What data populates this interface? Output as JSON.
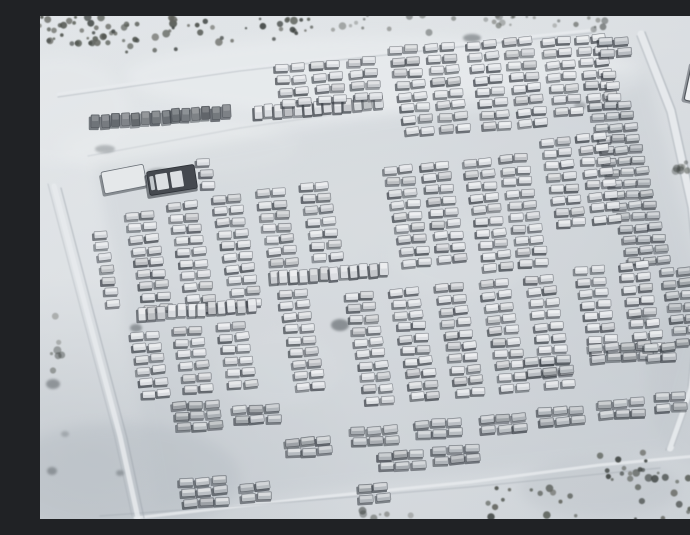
{
  "meta": {
    "title": "Satellite photograph of a snow-covered military vehicle staging area with hundreds of vehicles parked in rows, tree lines at the edges, access roads and tracks"
  },
  "scene": {
    "width": 690,
    "height": 503,
    "seed": 7,
    "palette": {
      "snow_base": "#d6dade",
      "snow_bright": "#eceff1",
      "snow_shade": "#b9bfc6",
      "track_bright": "#e8ebee",
      "track_dark": "#99a0a8",
      "vehicle_shadow": "#3a3f46",
      "tone_light": "#d7dade",
      "tone_mid": "#b3b8bd",
      "tone_dark": "#6e7378",
      "tree_palette": [
        "#4b4f4a",
        "#5a5e58",
        "#3e423f",
        "#63655e"
      ],
      "park_overlay": "#b6bdc4"
    },
    "snow_patches": [
      {
        "x": 345,
        "y": 60,
        "rx": 260,
        "ry": 40,
        "color": "#eceff1",
        "op": 0.5
      },
      {
        "x": 140,
        "y": 132,
        "rx": 120,
        "ry": 30,
        "color": "#e9eced",
        "op": 0.5
      },
      {
        "x": 20,
        "y": 95,
        "rx": 70,
        "ry": 55,
        "color": "#e8ebed",
        "op": 0.45
      },
      {
        "x": 420,
        "y": 240,
        "rx": 70,
        "ry": 40,
        "color": "#e7eaec",
        "op": 0.3
      },
      {
        "x": 240,
        "y": 352,
        "rx": 60,
        "ry": 40,
        "color": "#e4e8ea",
        "op": 0.28
      },
      {
        "x": 80,
        "y": 462,
        "rx": 120,
        "ry": 55,
        "color": "#aeb6bd",
        "op": 0.3
      },
      {
        "x": 662,
        "y": 360,
        "rx": 55,
        "ry": 90,
        "color": "#c2c8cd",
        "op": 0.35
      },
      {
        "x": 560,
        "y": 472,
        "rx": 80,
        "ry": 30,
        "color": "#b6bcc2",
        "op": 0.3
      }
    ],
    "park_overlay_polygon": "56,150 606,52 668,300 630,436 118,492",
    "tracks": [
      {
        "pts": [
          [
            18,
            78
          ],
          [
            200,
            52
          ],
          [
            400,
            30
          ],
          [
            552,
            14
          ]
        ],
        "w": 2.6,
        "color": "bright",
        "op": 0.85
      },
      {
        "pts": [
          [
            18,
            81
          ],
          [
            200,
            55
          ],
          [
            400,
            33
          ],
          [
            552,
            17
          ]
        ],
        "w": 1.0,
        "color": "dark",
        "op": 0.45
      },
      {
        "pts": [
          [
            601,
            18
          ],
          [
            631,
            95
          ],
          [
            652,
            190
          ],
          [
            661,
            280
          ],
          [
            652,
            370
          ],
          [
            630,
            432
          ]
        ],
        "w": 7,
        "color": "bright",
        "op": 0.9
      },
      {
        "pts": [
          [
            605,
            16
          ],
          [
            635,
            93
          ],
          [
            656,
            188
          ],
          [
            665,
            278
          ],
          [
            656,
            368
          ],
          [
            634,
            430
          ]
        ],
        "w": 1.3,
        "color": "dark",
        "op": 0.5
      },
      {
        "pts": [
          [
            597,
            20
          ],
          [
            627,
            97
          ],
          [
            648,
            192
          ],
          [
            657,
            282
          ],
          [
            648,
            372
          ],
          [
            626,
            434
          ]
        ],
        "w": 1.3,
        "color": "dark",
        "op": 0.4
      },
      {
        "pts": [
          [
            95,
            502
          ],
          [
            280,
            481
          ],
          [
            430,
            466
          ],
          [
            560,
            449
          ],
          [
            688,
            437
          ]
        ],
        "w": 3,
        "color": "bright",
        "op": 0.8
      },
      {
        "pts": [
          [
            60,
            500
          ],
          [
            250,
            486
          ],
          [
            430,
            471
          ],
          [
            620,
            452
          ]
        ],
        "w": 1.4,
        "color": "dark",
        "op": 0.35
      },
      {
        "pts": [
          [
            14,
            170
          ],
          [
            48,
            300
          ],
          [
            80,
            420
          ],
          [
            98,
            502
          ]
        ],
        "w": 5,
        "color": "bright",
        "op": 0.85
      },
      {
        "pts": [
          [
            21,
            172
          ],
          [
            55,
            302
          ],
          [
            87,
            422
          ],
          [
            104,
            502
          ]
        ],
        "w": 1.3,
        "color": "dark",
        "op": 0.5
      },
      {
        "pts": [
          [
            8,
            168
          ],
          [
            42,
            298
          ],
          [
            74,
            418
          ],
          [
            92,
            500
          ]
        ],
        "w": 1.1,
        "color": "dark",
        "op": 0.35
      },
      {
        "pts": [
          [
            48,
            140
          ],
          [
            200,
            112
          ],
          [
            340,
            92
          ]
        ],
        "w": 1.4,
        "color": "dark",
        "op": 0.22
      }
    ],
    "dark_patches": [
      {
        "x": 300,
        "y": 309,
        "rx": 9,
        "ry": 6,
        "op": 0.5
      },
      {
        "x": 96,
        "y": 312,
        "rx": 6,
        "ry": 4,
        "op": 0.45
      },
      {
        "x": 600,
        "y": 304,
        "rx": 10,
        "ry": 5,
        "op": 0.4
      },
      {
        "x": 13,
        "y": 368,
        "rx": 7,
        "ry": 5,
        "op": 0.45
      },
      {
        "x": 12,
        "y": 455,
        "rx": 5,
        "ry": 4,
        "op": 0.4
      },
      {
        "x": 80,
        "y": 457,
        "rx": 4,
        "ry": 3,
        "op": 0.35
      },
      {
        "x": 25,
        "y": 418,
        "rx": 4,
        "ry": 3,
        "op": 0.25
      },
      {
        "x": 120,
        "y": 158,
        "rx": 14,
        "ry": 6,
        "op": 0.3
      },
      {
        "x": 432,
        "y": 22,
        "rx": 9,
        "ry": 4,
        "op": 0.45
      },
      {
        "x": 65,
        "y": 133,
        "rx": 10,
        "ry": 4,
        "op": 0.3
      },
      {
        "x": 540,
        "y": 90,
        "rx": 6,
        "ry": 4,
        "op": 0.3
      }
    ],
    "trees": {
      "clusters": [
        {
          "cx": 28,
          "cy": 14,
          "rx": 34,
          "ry": 14,
          "count": 26
        },
        {
          "cx": 96,
          "cy": 24,
          "rx": 40,
          "ry": 16,
          "count": 22
        },
        {
          "cx": 180,
          "cy": 14,
          "rx": 55,
          "ry": 13,
          "count": 18
        },
        {
          "cx": 252,
          "cy": 9,
          "rx": 28,
          "ry": 9,
          "count": 12
        },
        {
          "cx": 330,
          "cy": 7,
          "rx": 40,
          "ry": 8,
          "count": 9,
          "faint": true
        },
        {
          "cx": 455,
          "cy": 8,
          "rx": 75,
          "ry": 9,
          "count": 16,
          "faint": true
        },
        {
          "cx": 555,
          "cy": 7,
          "rx": 25,
          "ry": 7,
          "count": 7,
          "faint": true
        },
        {
          "cx": 640,
          "cy": 478,
          "rx": 52,
          "ry": 26,
          "count": 30
        },
        {
          "cx": 582,
          "cy": 452,
          "rx": 28,
          "ry": 16,
          "count": 12
        },
        {
          "cx": 492,
          "cy": 487,
          "rx": 45,
          "ry": 15,
          "count": 14
        },
        {
          "cx": 12,
          "cy": 345,
          "rx": 10,
          "ry": 45,
          "count": 7,
          "faint": true
        },
        {
          "cx": 358,
          "cy": 499,
          "rx": 38,
          "ry": 6,
          "count": 6,
          "faint": true
        },
        {
          "cx": 668,
          "cy": 228,
          "rx": 8,
          "ry": 55,
          "count": 10,
          "faint": true
        },
        {
          "cx": 643,
          "cy": 153,
          "rx": 13,
          "ry": 9,
          "count": 7,
          "faint": true
        }
      ]
    },
    "structures": {
      "building": {
        "x": 656,
        "y": 66,
        "w": 16,
        "h": 40,
        "rot": 12,
        "fill": "#eef0f2",
        "stroke": "#53585e"
      },
      "shelter": {
        "x": 84,
        "y": 163,
        "w": 43,
        "h": 22,
        "rot": -11,
        "fill": "#e5e8ea",
        "stroke": "#6a7077"
      },
      "transporter": {
        "x": 132,
        "y": 164,
        "w": 48,
        "h": 24,
        "rot": -9,
        "fill": "#45494f",
        "panel": "#dde0e3"
      }
    },
    "formation_defaults": {
      "pair": {
        "rows": 8,
        "cols": 2,
        "vw": 13,
        "vh": 7,
        "rs": [
          2.3,
          11.6
        ],
        "cs": [
          15.5,
          -1.4
        ],
        "vr": -4,
        "tone": "light"
      },
      "col": {
        "rows": 5,
        "cols": 1,
        "vw": 13,
        "vh": 7,
        "rs": [
          2.3,
          11.6
        ],
        "cs": [
          15.5,
          -1.4
        ],
        "vr": -4,
        "tone": "light"
      },
      "row": {
        "rows": 1,
        "cols": 12,
        "vw": 8.5,
        "vh": 13,
        "rs": [
          2.3,
          11.6
        ],
        "cs": [
          10,
          -0.8
        ],
        "vr": -3,
        "tone": "light"
      },
      "dense": {
        "rows": 15,
        "cols": 3,
        "vw": 13,
        "vh": 6.6,
        "rs": [
          2.8,
          11.1
        ],
        "cs": [
          14.5,
          -1.0
        ],
        "vr": -4,
        "tone": "mid"
      },
      "cluster": {
        "rows": 2,
        "cols": 3,
        "vw": 14,
        "vh": 7.5,
        "rs": [
          2.0,
          10.5
        ],
        "cs": [
          16,
          -1.2
        ],
        "vr": -4,
        "tone": "mid"
      }
    },
    "formations": [
      {
        "id": "row-nw-dark",
        "type": "row",
        "x": 56,
        "y": 106,
        "cols": 14,
        "tone": "dark"
      },
      {
        "id": "row-n-light",
        "type": "row",
        "x": 218,
        "y": 96,
        "cols": 13
      },
      {
        "id": "p-top-1",
        "type": "pair",
        "x": 242,
        "y": 52,
        "rows": 4
      },
      {
        "id": "p-top-2",
        "type": "pair",
        "x": 278,
        "y": 49,
        "rows": 4
      },
      {
        "id": "p-top-3",
        "type": "pair",
        "x": 314,
        "y": 46,
        "rows": 4
      },
      {
        "id": "p-top-4",
        "type": "pair",
        "x": 356,
        "y": 34,
        "rows": 8
      },
      {
        "id": "p-top-5",
        "type": "pair",
        "x": 392,
        "y": 31,
        "rows": 8
      },
      {
        "id": "p-top-6",
        "type": "pair",
        "x": 434,
        "y": 29,
        "rows": 8
      },
      {
        "id": "p-top-7",
        "type": "pair",
        "x": 470,
        "y": 26,
        "rows": 8
      },
      {
        "id": "p-top-8",
        "type": "pair",
        "x": 508,
        "y": 26,
        "rows": 7
      },
      {
        "id": "p-top-9",
        "type": "pair",
        "x": 543,
        "y": 23,
        "rows": 6
      },
      {
        "id": "c-top-ne",
        "type": "cluster",
        "x": 566,
        "y": 26,
        "rows": 2,
        "cols": 2
      },
      {
        "id": "col-ne-small",
        "type": "col",
        "x": 570,
        "y": 58,
        "rows": 3
      },
      {
        "id": "dense-ne",
        "type": "dense",
        "x": 556,
        "y": 90
      },
      {
        "id": "col-w-single",
        "type": "col",
        "x": 60,
        "y": 218,
        "rows": 7
      },
      {
        "id": "p-mid-w1",
        "type": "pair",
        "x": 92,
        "y": 200,
        "rows": 9
      },
      {
        "id": "p-mid-w2",
        "type": "pair",
        "x": 135,
        "y": 190,
        "rows": 10
      },
      {
        "id": "p-mid-w3",
        "type": "pair",
        "x": 179,
        "y": 183,
        "rows": 10
      },
      {
        "id": "p-mid-w4",
        "type": "pair",
        "x": 223,
        "y": 177,
        "rows": 7
      },
      {
        "id": "p-mid-w5",
        "type": "pair",
        "x": 267,
        "y": 171,
        "rows": 7
      },
      {
        "id": "row-mid-w",
        "type": "row",
        "x": 102,
        "y": 298,
        "cols": 12
      },
      {
        "id": "row-mid-c",
        "type": "row",
        "x": 234,
        "y": 262,
        "cols": 12
      },
      {
        "id": "p-mid-c1",
        "type": "pair",
        "x": 351,
        "y": 154,
        "rows": 9
      },
      {
        "id": "p-mid-c2",
        "type": "pair",
        "x": 387,
        "y": 150,
        "rows": 9
      },
      {
        "id": "p-mid-c3",
        "type": "pair",
        "x": 430,
        "y": 147,
        "rows": 10
      },
      {
        "id": "p-mid-c4",
        "type": "pair",
        "x": 466,
        "y": 143,
        "rows": 10
      },
      {
        "id": "p-mid-e1",
        "type": "pair",
        "x": 508,
        "y": 126,
        "rows": 8
      },
      {
        "id": "p-mid-e2",
        "type": "pair",
        "x": 544,
        "y": 122,
        "rows": 8
      },
      {
        "id": "p-low-w1",
        "type": "pair",
        "x": 97,
        "y": 320,
        "rows": 6
      },
      {
        "id": "p-low-w2",
        "type": "pair",
        "x": 140,
        "y": 315,
        "rows": 6
      },
      {
        "id": "p-low-w3",
        "type": "pair",
        "x": 184,
        "y": 310,
        "rows": 6
      },
      {
        "id": "p-low-w4",
        "type": "pair",
        "x": 245,
        "y": 278,
        "rows": 9
      },
      {
        "id": "p-low-c1",
        "type": "pair",
        "x": 312,
        "y": 280,
        "rows": 10
      },
      {
        "id": "p-low-c2",
        "type": "pair",
        "x": 357,
        "y": 276,
        "rows": 10
      },
      {
        "id": "p-low-c3",
        "type": "pair",
        "x": 402,
        "y": 272,
        "rows": 10
      },
      {
        "id": "p-low-c4",
        "type": "pair",
        "x": 447,
        "y": 268,
        "rows": 10
      },
      {
        "id": "p-low-c5",
        "type": "pair",
        "x": 492,
        "y": 264,
        "rows": 10
      },
      {
        "id": "p-low-e1",
        "type": "pair",
        "x": 542,
        "y": 254,
        "rows": 8
      },
      {
        "id": "p-low-e2",
        "type": "pair",
        "x": 586,
        "y": 250,
        "rows": 8
      },
      {
        "id": "p-low-e3",
        "type": "pair",
        "x": 628,
        "y": 256,
        "rows": 7,
        "tone": "mid"
      },
      {
        "id": "col-nw-trucks",
        "type": "col",
        "x": 164,
        "y": 146,
        "rows": 3
      },
      {
        "id": "cl-sw-1",
        "type": "cluster",
        "x": 140,
        "y": 390,
        "rows": 3
      },
      {
        "id": "cl-sw-2",
        "type": "cluster",
        "x": 200,
        "y": 394,
        "rows": 2
      },
      {
        "id": "cl-s-1",
        "type": "cluster",
        "x": 252,
        "y": 426
      },
      {
        "id": "cl-s-2",
        "type": "cluster",
        "x": 318,
        "y": 415
      },
      {
        "id": "cl-s-3",
        "type": "cluster",
        "x": 382,
        "y": 408
      },
      {
        "id": "cl-s-4",
        "type": "cluster",
        "x": 447,
        "y": 403
      },
      {
        "id": "cl-s-5",
        "type": "cluster",
        "x": 505,
        "y": 396
      },
      {
        "id": "cl-s-6",
        "type": "cluster",
        "x": 565,
        "y": 388
      },
      {
        "id": "cl-s-7",
        "type": "cluster",
        "x": 622,
        "y": 381,
        "cols": 2
      },
      {
        "id": "cl-s-8",
        "type": "cluster",
        "x": 345,
        "y": 440
      },
      {
        "id": "cl-s-9",
        "type": "cluster",
        "x": 400,
        "y": 434
      },
      {
        "id": "cl-se-1",
        "type": "cluster",
        "x": 492,
        "y": 346
      },
      {
        "id": "cl-se-2",
        "type": "cluster",
        "x": 556,
        "y": 332,
        "cols": 4
      },
      {
        "id": "cl-se-3",
        "type": "cluster",
        "x": 612,
        "y": 332,
        "cols": 2
      },
      {
        "id": "cl-b-1",
        "type": "cluster",
        "x": 147,
        "y": 466,
        "rows": 3
      },
      {
        "id": "cl-b-2",
        "type": "cluster",
        "x": 207,
        "y": 471,
        "cols": 2
      },
      {
        "id": "cl-b-3",
        "type": "cluster",
        "x": 325,
        "y": 472,
        "rows": 2,
        "cols": 2
      }
    ]
  }
}
